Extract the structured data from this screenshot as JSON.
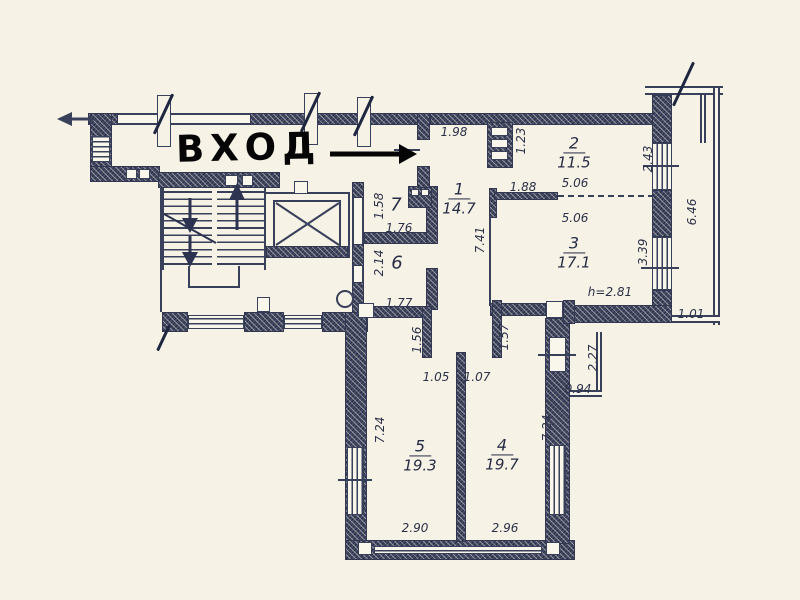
{
  "annotation": {
    "entrance_label": "ВХОД"
  },
  "rooms": {
    "r1": {
      "num": "1",
      "area": "14.7"
    },
    "r2": {
      "num": "2",
      "area": "11.5"
    },
    "r3": {
      "num": "3",
      "area": "17.1"
    },
    "r4": {
      "num": "4",
      "area": "19.7"
    },
    "r5": {
      "num": "5",
      "area": "19.3"
    },
    "r6": {
      "num": "6"
    },
    "r7": {
      "num": "7"
    }
  },
  "dims": {
    "d198": "1.98",
    "d123": "1.23",
    "d188": "1.88",
    "d506a": "5.06",
    "d506b": "5.06",
    "d243": "2.43",
    "d646": "6.46",
    "d339": "3.39",
    "d101": "1.01",
    "h281": "h=2.81",
    "d741": "7.41",
    "d158": "1.58",
    "d176": "1.76",
    "d214": "2.14",
    "d177": "1.77",
    "d156": "1.56",
    "d157": "1.57",
    "d105": "1.05",
    "d107": "1.07",
    "d724l": "7.24",
    "d724r": "7.24",
    "d290": "2.90",
    "d296": "2.96",
    "d094": "0.94",
    "d227": "2.27"
  },
  "colors": {
    "ink": "#39405a",
    "paper": "#f6f2e6",
    "annotation": "#000000"
  }
}
